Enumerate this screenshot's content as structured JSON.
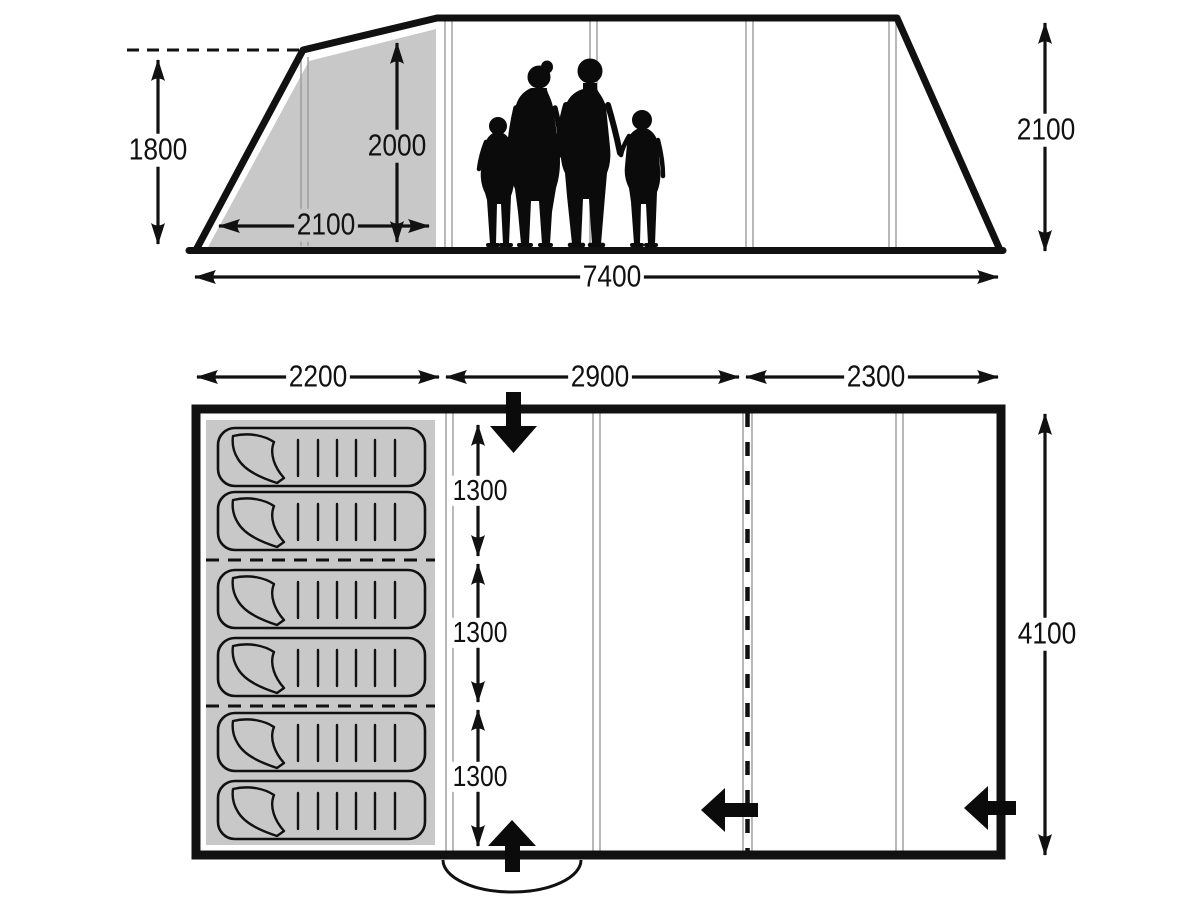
{
  "side_view": {
    "left_wall_height_mm": "1800",
    "bedroom_height_mm": "2000",
    "bedroom_width_mm": "2100",
    "total_length_mm": "7400",
    "right_wall_height_mm": "2100"
  },
  "floor_plan": {
    "section_widths_mm": [
      "2200",
      "2900",
      "2300"
    ],
    "bed_section_depths_mm": [
      "1300",
      "1300",
      "1300"
    ],
    "total_width_mm": "4100",
    "sleeping_bag_count": 6
  },
  "colors": {
    "line": "#111111",
    "shaded_area": "#c8c8c8",
    "pole_line": "#9b9b9b"
  }
}
